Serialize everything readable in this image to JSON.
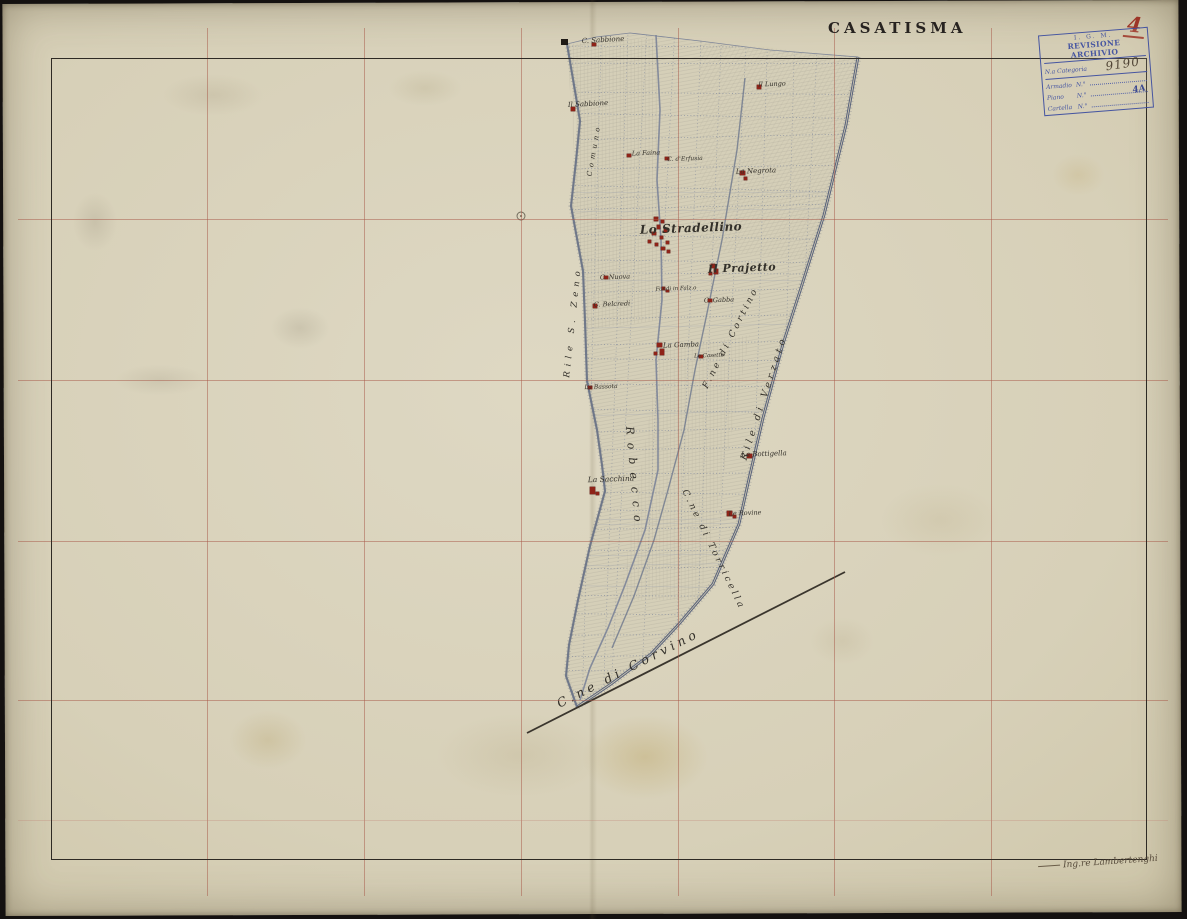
{
  "header": {
    "title": "CASATISMA",
    "sheet_number": "4"
  },
  "stamp": {
    "agency": "I. G. M.",
    "title": "REVISIONE ARCHIVIO",
    "category_label": "N.a Categoria",
    "category_value": "9190",
    "rows": [
      {
        "label": "Armadio",
        "n": "N.°",
        "value": ""
      },
      {
        "label": "Piano",
        "n": "N.°",
        "value": "4A"
      },
      {
        "label": "Cartella",
        "n": "N.°",
        "value": ""
      }
    ]
  },
  "signature": {
    "text": "Ing.re Lambertenghi"
  },
  "colors": {
    "paper": "#d9d3bb",
    "frame_ink": "#2e2a24",
    "grid_line": "#a85848",
    "faint_grid_line": "#c08275",
    "building_red": "#8f2318",
    "road_blue": "#5c6678",
    "stamp_blue": "#3c4da0",
    "number_red": "#9d3527"
  },
  "grid": {
    "vertical_x": [
      207,
      364,
      521,
      678,
      834,
      991
    ],
    "horizontal_y": [
      219,
      380,
      541,
      700
    ],
    "faint_horizontal_y": 820,
    "frame": {
      "left": 51,
      "top": 58,
      "width": 1096,
      "height": 802
    }
  },
  "map": {
    "labels": [
      {
        "t": "C. Sabbione",
        "x": 603,
        "y": 40,
        "r": -3,
        "s": 7,
        "w": "normal",
        "ls": 0
      },
      {
        "t": "Il Sabbione",
        "x": 588,
        "y": 104,
        "r": -3,
        "s": 7,
        "w": "normal",
        "ls": 0
      },
      {
        "t": "La Faina",
        "x": 646,
        "y": 153,
        "r": -2,
        "s": 6.5,
        "w": "normal",
        "ls": 0
      },
      {
        "t": "C. d'Erfusia",
        "x": 685,
        "y": 159,
        "r": -2,
        "s": 6,
        "w": "normal",
        "ls": 0
      },
      {
        "t": "Il Lungo",
        "x": 772,
        "y": 84,
        "r": -2,
        "s": 6.5,
        "w": "normal",
        "ls": 0
      },
      {
        "t": "La Negrota",
        "x": 756,
        "y": 171,
        "r": -2,
        "s": 7,
        "w": "normal",
        "ls": 0
      },
      {
        "t": "Lo Stradellino",
        "x": 691,
        "y": 228,
        "r": -2,
        "s": 12,
        "w": "bold",
        "ls": 0.5
      },
      {
        "t": "Il Prajetto",
        "x": 742,
        "y": 268,
        "r": -2,
        "s": 11,
        "w": "bold",
        "ls": 0.5
      },
      {
        "t": "C. Nuova",
        "x": 615,
        "y": 277,
        "r": -2,
        "s": 6.5,
        "w": "normal",
        "ls": 0
      },
      {
        "t": "C. Belcredi",
        "x": 612,
        "y": 304,
        "r": -2,
        "s": 6.5,
        "w": "normal",
        "ls": 0
      },
      {
        "t": "Fondi in Falz.o",
        "x": 676,
        "y": 289,
        "r": -2,
        "s": 5.5,
        "w": "normal",
        "ls": 0
      },
      {
        "t": "C. Gabba",
        "x": 719,
        "y": 300,
        "r": -2,
        "s": 6.5,
        "w": "normal",
        "ls": 0
      },
      {
        "t": "La Gamba",
        "x": 681,
        "y": 345,
        "r": -2,
        "s": 7,
        "w": "normal",
        "ls": 0
      },
      {
        "t": "Le Casette",
        "x": 709,
        "y": 356,
        "r": -2,
        "s": 5.5,
        "w": "normal",
        "ls": 0
      },
      {
        "t": "La Bassota",
        "x": 601,
        "y": 387,
        "r": -2,
        "s": 6,
        "w": "normal",
        "ls": 0
      },
      {
        "t": "La Sacchina",
        "x": 611,
        "y": 479,
        "r": -2,
        "s": 7.5,
        "w": "normal",
        "ls": 0
      },
      {
        "t": "La Bottigella",
        "x": 764,
        "y": 454,
        "r": -2,
        "s": 7,
        "w": "normal",
        "ls": 0
      },
      {
        "t": "Le Rovine",
        "x": 745,
        "y": 513,
        "r": -2,
        "s": 6.5,
        "w": "normal",
        "ls": 0
      },
      {
        "t": "Comuno",
        "x": 594,
        "y": 150,
        "r": -80,
        "s": 7,
        "w": "normal",
        "ls": 4
      },
      {
        "t": "Rile S. Zeno",
        "x": 573,
        "y": 322,
        "r": -84,
        "s": 8.5,
        "w": "normal",
        "ls": 5
      },
      {
        "t": "Robecco",
        "x": 634,
        "y": 478,
        "r": 85,
        "s": 11,
        "w": "normal",
        "ls": 8
      },
      {
        "t": "F.ne di Cortino",
        "x": 731,
        "y": 338,
        "r": -63,
        "s": 9,
        "w": "normal",
        "ls": 3
      },
      {
        "t": "Rile di Verzato",
        "x": 764,
        "y": 398,
        "r": -72,
        "s": 9.5,
        "w": "normal",
        "ls": 4
      },
      {
        "t": "C.ne di Torricella",
        "x": 713,
        "y": 550,
        "r": 64,
        "s": 9,
        "w": "normal",
        "ls": 3
      },
      {
        "t": "C.ne di Corvino",
        "x": 628,
        "y": 668,
        "r": -27,
        "s": 12.5,
        "w": "normal",
        "ls": 4
      }
    ],
    "buildings": [
      [
        592,
        43,
        4,
        3
      ],
      [
        571,
        107,
        4,
        4
      ],
      [
        627,
        154,
        4,
        3
      ],
      [
        665,
        157,
        4,
        3
      ],
      [
        757,
        85,
        4,
        4
      ],
      [
        740,
        171,
        5,
        4
      ],
      [
        744,
        177,
        3,
        3
      ],
      [
        654,
        217,
        4,
        4
      ],
      [
        661,
        220,
        3,
        3
      ],
      [
        657,
        225,
        3,
        4
      ],
      [
        664,
        229,
        3,
        3
      ],
      [
        652,
        232,
        4,
        3
      ],
      [
        660,
        236,
        3,
        3
      ],
      [
        666,
        241,
        3,
        3
      ],
      [
        655,
        243,
        3,
        3
      ],
      [
        661,
        247,
        4,
        3
      ],
      [
        648,
        240,
        3,
        3
      ],
      [
        667,
        250,
        3,
        3
      ],
      [
        604,
        276,
        4,
        3
      ],
      [
        593,
        304,
        4,
        4
      ],
      [
        711,
        264,
        4,
        4
      ],
      [
        714,
        269,
        4,
        5
      ],
      [
        709,
        272,
        3,
        3
      ],
      [
        662,
        287,
        3,
        3
      ],
      [
        666,
        290,
        3,
        2
      ],
      [
        708,
        299,
        4,
        3
      ],
      [
        657,
        343,
        5,
        4
      ],
      [
        660,
        349,
        4,
        6
      ],
      [
        654,
        352,
        3,
        3
      ],
      [
        699,
        355,
        4,
        3
      ],
      [
        588,
        386,
        4,
        3
      ],
      [
        590,
        487,
        5,
        7
      ],
      [
        596,
        492,
        3,
        3
      ],
      [
        747,
        454,
        5,
        4
      ],
      [
        727,
        511,
        5,
        5
      ],
      [
        733,
        515,
        3,
        3
      ]
    ],
    "north_mark": {
      "x": 561,
      "y": 39,
      "w": 7,
      "h": 6
    },
    "survey_circle": {
      "x": 521,
      "y": 216
    }
  }
}
